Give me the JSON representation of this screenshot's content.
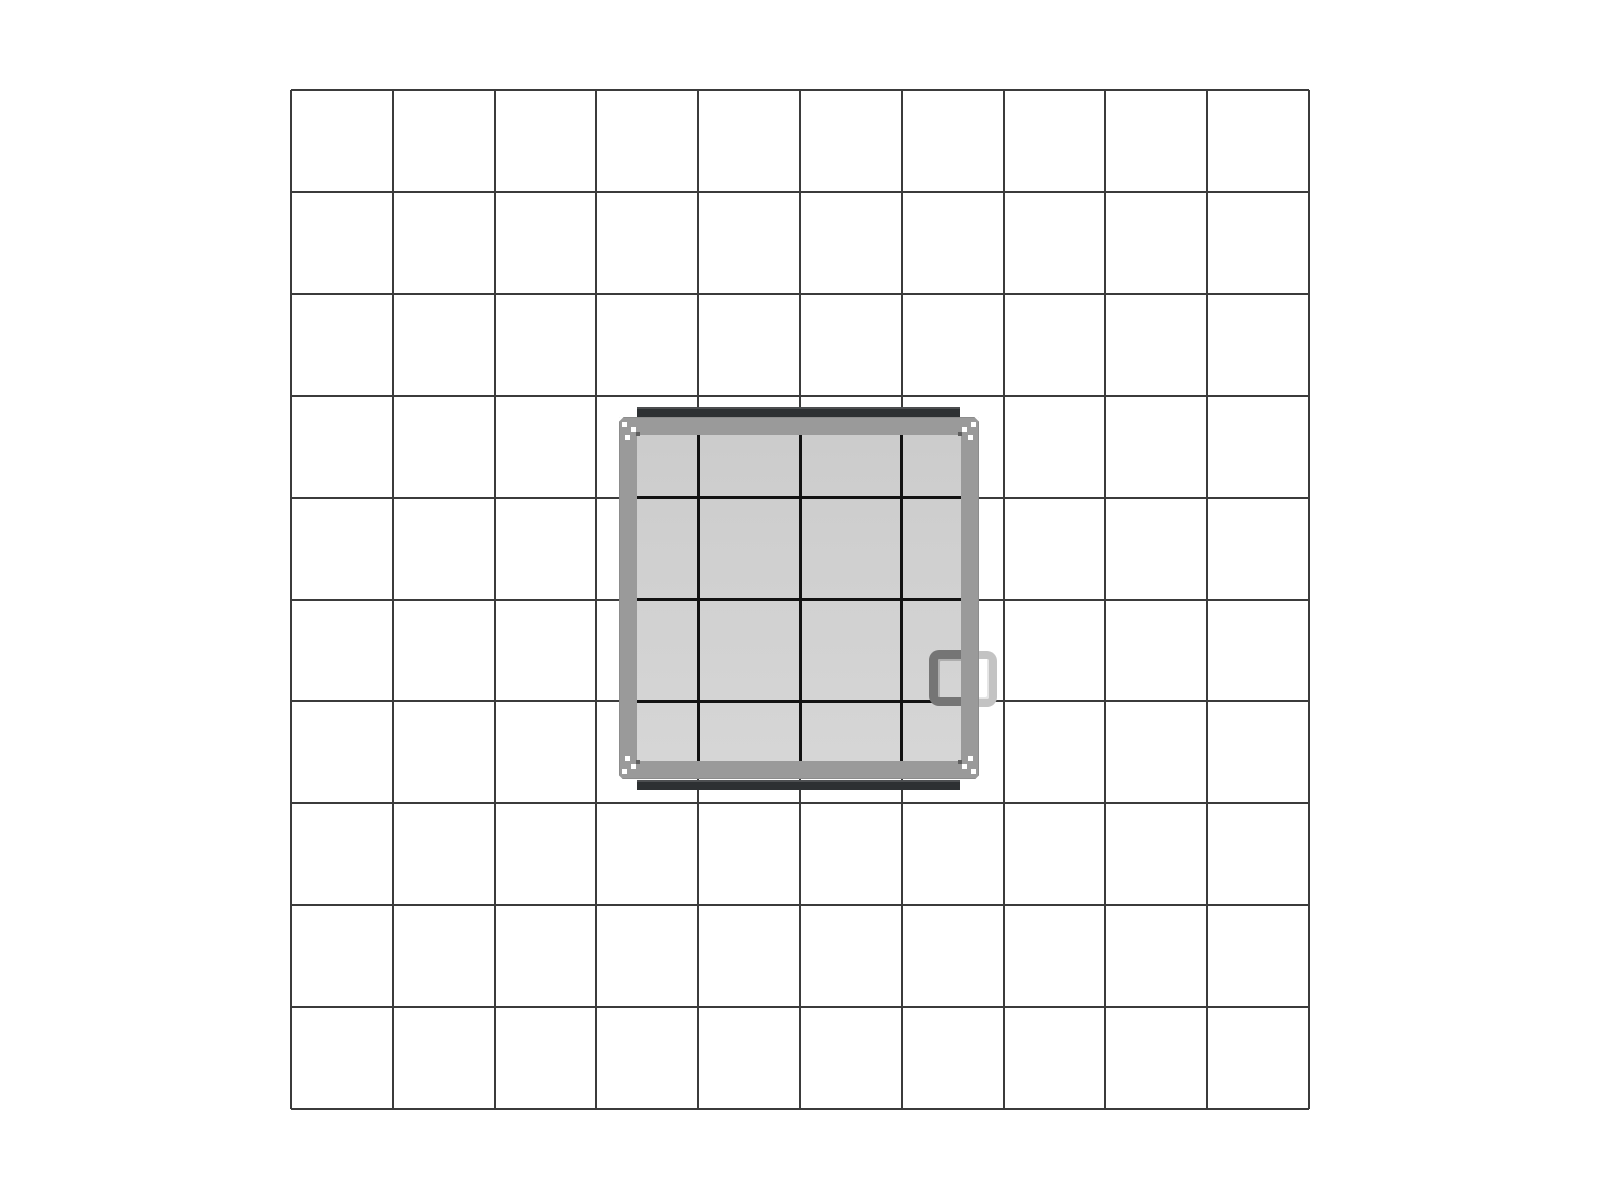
{
  "canvas": {
    "width": 1600,
    "height": 1200,
    "background_color": "#ffffff"
  },
  "grid": {
    "left": 291,
    "top": 90,
    "width": 1018,
    "height": 1019,
    "columns": 10,
    "rows": 10,
    "line_width": 2,
    "line_color": "#3b3b3b"
  },
  "panel": {
    "left": 620,
    "top": 418,
    "width": 358,
    "height": 360,
    "frame_thickness": 17,
    "frame_color": "#9a9a9a",
    "frame_edge_color": "#8c8c8c",
    "interior_color_top": "#cccccc",
    "interior_color_bottom": "#d6d6d6",
    "interior_line_color": "#121212",
    "interior_line_width": 3,
    "top_bar": {
      "left": 637,
      "top": 407,
      "width": 323,
      "height": 10,
      "color": "#2d3032",
      "highlight": "rgba(255,255,255,0.15)"
    },
    "bottom_bar": {
      "left": 637,
      "top": 780,
      "width": 323,
      "height": 10,
      "color": "#2d3032",
      "highlight": "rgba(255,255,255,0.15)"
    },
    "inner_handle": {
      "left": 929,
      "top": 650,
      "width": 33,
      "height": 56,
      "stroke": 9,
      "color": "#757575",
      "shade": "rgba(0,0,0,0.18)",
      "radius": 10
    },
    "outer_handle": {
      "left": 974,
      "top": 651,
      "width": 23,
      "height": 56,
      "stroke": 8,
      "color": "#c3c3c3",
      "shade": "rgba(0,0,0,0.10)",
      "radius": 10
    },
    "corner_marks": {
      "screw_color": "#ffffff",
      "screw_size": 5,
      "screw_offsets": [
        [
          2,
          4
        ],
        [
          11,
          9
        ],
        [
          5,
          17
        ]
      ],
      "tick_color": "#5f5f5f",
      "tick_size": 4,
      "tick_offset": [
        16,
        14
      ],
      "diag_length": 14,
      "diag_width": 3,
      "diag_color": "#ffffff"
    }
  }
}
